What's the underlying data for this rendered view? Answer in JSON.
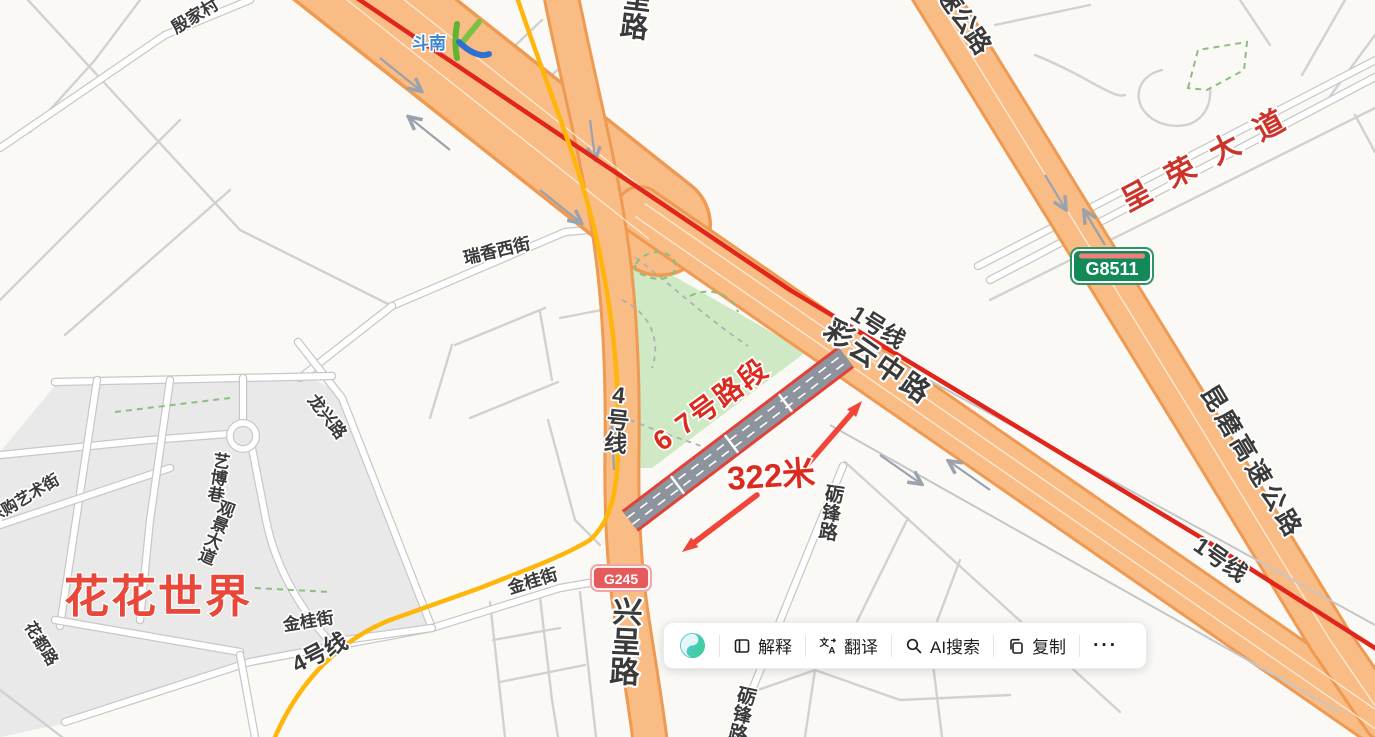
{
  "map": {
    "road_labels": {
      "yinjiacun": "殷家村",
      "top_partial_road": "呈路",
      "top_partial_highway": "速公路",
      "ruixiang": "瑞香西街",
      "caiyun": "彩云中路",
      "line1_a": "1号线",
      "line1_b": "1号线",
      "line4_vertical": "4号线",
      "line4_diagonal": "4号线",
      "chengrong": "呈荣大道",
      "kunmo": "昆磨高速公路",
      "xingcheng": "兴呈路",
      "jingui_a": "金桂街",
      "jingui_b": "金桂街",
      "longxing": "龙兴路",
      "yibo": "艺博巷",
      "guanjing": "观景大道",
      "legou": "乐购艺术街",
      "huadu": "花都路",
      "lifeng_a": "砺锋路",
      "lifeng_b": "砺锋路"
    },
    "poi_labels": {
      "huahua_world": "花花世界",
      "dounan": "斗南"
    },
    "badges": {
      "g8511": "G8511",
      "g245": "G245"
    },
    "annotation": {
      "segment_label": "6 7号路段",
      "distance_label": "322米"
    },
    "colors": {
      "road_orange": "#F9BC85",
      "metro_line1_red": "#E1251B",
      "metro_line4_yellow": "#FFB60A",
      "annotation_red": "#DD2A1E",
      "park_green": "#CFE9C4",
      "highlight_gray": "#8D949E",
      "expressway_badge_green": "#128A57",
      "national_badge_red": "#E55A5A"
    }
  },
  "toolbar": {
    "logo_icon": "ai-assistant-logo",
    "buttons": [
      {
        "icon": "book-icon",
        "label": "解释"
      },
      {
        "icon": "translate-icon",
        "label": "翻译"
      },
      {
        "icon": "search-icon",
        "label": "AI搜索"
      },
      {
        "icon": "copy-icon",
        "label": "复制"
      }
    ],
    "more_label": "···"
  }
}
